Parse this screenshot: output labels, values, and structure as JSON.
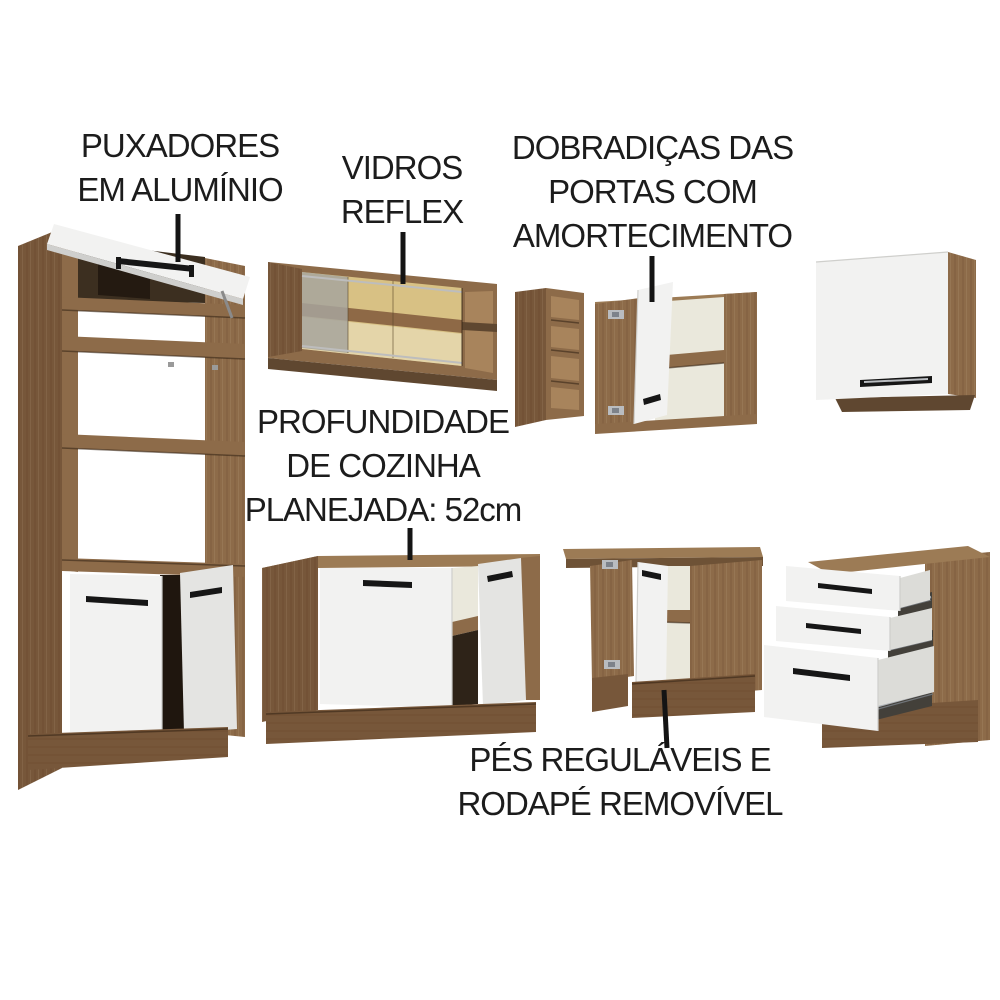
{
  "annotations": {
    "handles": {
      "lines": [
        "PUXADORES",
        "EM ALUMÍNIO"
      ]
    },
    "glass": {
      "lines": [
        "VIDROS",
        "REFLEX"
      ]
    },
    "hinges": {
      "lines": [
        "DOBRADIÇAS DAS",
        "PORTAS COM",
        "AMORTECIMENTO"
      ]
    },
    "depth": {
      "lines": [
        "PROFUNDIDADE",
        "DE COZINHA",
        "PLANEJADA: 52cm"
      ]
    },
    "feet": {
      "lines": [
        "PÉS REGULÁVEIS E",
        "RODAPÉ REMOVÍVEL"
      ]
    }
  },
  "furniture": [
    {
      "id": "tall-oven-cabinet",
      "description": "tall tower with lift-up top door, open oven shelves and two bottom doors"
    },
    {
      "id": "glass-wall-cabinet",
      "description": "wall cabinet with reflex sliding glass doors and open end shelves"
    },
    {
      "id": "open-shelf-unit",
      "description": "narrow vertical open shelf unit"
    },
    {
      "id": "corner-wall-cabinet",
      "description": "corner wall cabinet with open door on soft-close hinges"
    },
    {
      "id": "wall-cabinet",
      "description": "single-door wall cabinet"
    },
    {
      "id": "sink-base-cabinet",
      "description": "base cabinet with closed door, open shelf and open door"
    },
    {
      "id": "corner-base-cabinet",
      "description": "corner base cabinet with open door, adjustable feet and removable plinth"
    },
    {
      "id": "drawer-base-cabinet",
      "description": "base cabinet with three extended drawers"
    }
  ],
  "colors": {
    "background": "#ffffff",
    "text": "#1c1c1c",
    "line-black": "#141414",
    "wood-face": "#8d6b49",
    "wood-side": "#77573a",
    "wood-top": "#9c7b55",
    "wood-dark": "#5f4730",
    "wood-interior": "#a8845c",
    "white-panel": "#f2f2f1",
    "white-shade": "#e4e4e2",
    "drawer-body": "#dcdcd8",
    "interior-white": "#eae8dc",
    "glass-amber": "#d8c184",
    "glass-gray": "#a7a49c",
    "handle-black": "#161616",
    "hinge-silver": "#b9bcc0",
    "rail-silver": "#a9adb2",
    "shadow-dark": "#3c2f20",
    "cavity-dark": "#43403a"
  }
}
